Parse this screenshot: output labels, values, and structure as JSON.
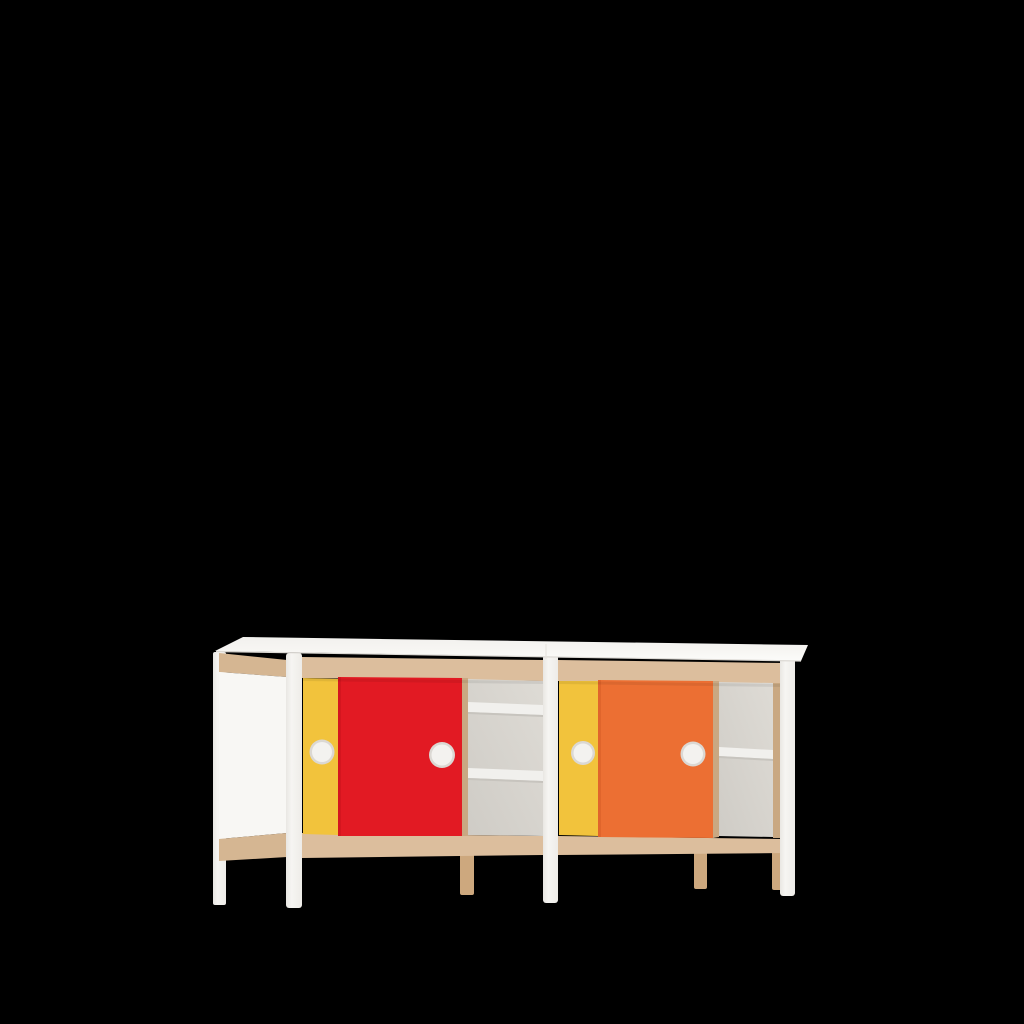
{
  "scene": {
    "type": "3d-product-render",
    "subject": "Two-bay sideboard with colored sliding doors, round white handles and open shelf compartments",
    "view": "front three-quarter, slight left perspective",
    "background": "#000000"
  },
  "palette": {
    "background": "#000000",
    "top_white": "#f6f5f2",
    "top_edge_white": "#fbfbf9",
    "frame_white": "#f3f2ef",
    "panel_white": "#f8f7f4",
    "wood": "#dcbe9d",
    "wood_side": "#d5b692",
    "wood_dark": "#c9a882",
    "wood_leg": "#cda87e",
    "door_yellow": "#f2c33c",
    "door_red": "#e21a23",
    "door_orange": "#ec6f33",
    "interior_gray": "#d4d1cb",
    "interior_highlight": "#e2dfd9",
    "shelf_white": "#f1f0ed",
    "shelf_shadow": "#c7c4be",
    "handle_white": "#f3f2ef",
    "handle_ring": "#dbd8d3"
  },
  "furniture": {
    "frame": {
      "top": "white slab with slight overhang",
      "rails": "beech wood, top and bottom",
      "posts": "white, front corners and middle",
      "legs_front": "white",
      "legs_rear": "beech wood",
      "left_end": "white side panel framed in beech"
    },
    "units": [
      {
        "id": "left-bay",
        "doors": [
          {
            "color_name": "yellow",
            "hex": "#f2c33c",
            "position": "rear track, mostly hidden",
            "handle": "round white"
          },
          {
            "color_name": "red",
            "hex": "#e21a23",
            "position": "front track, closed over middle",
            "handle": "round white"
          }
        ],
        "open_compartment": {
          "shelves": 2,
          "back_color": "#d4d1cb",
          "shelf_color": "#f1f0ed"
        }
      },
      {
        "id": "right-bay",
        "doors": [
          {
            "color_name": "yellow",
            "hex": "#f2c33c",
            "position": "rear track, mostly hidden",
            "handle": "round white"
          },
          {
            "color_name": "orange",
            "hex": "#ec6f33",
            "position": "front track, closed over middle",
            "handle": "round white"
          }
        ],
        "open_compartment": {
          "shelves": 1,
          "back_color": "#d4d1cb",
          "shelf_color": "#f1f0ed"
        }
      }
    ],
    "handle_count": 4,
    "leg_count_visible": 7
  }
}
